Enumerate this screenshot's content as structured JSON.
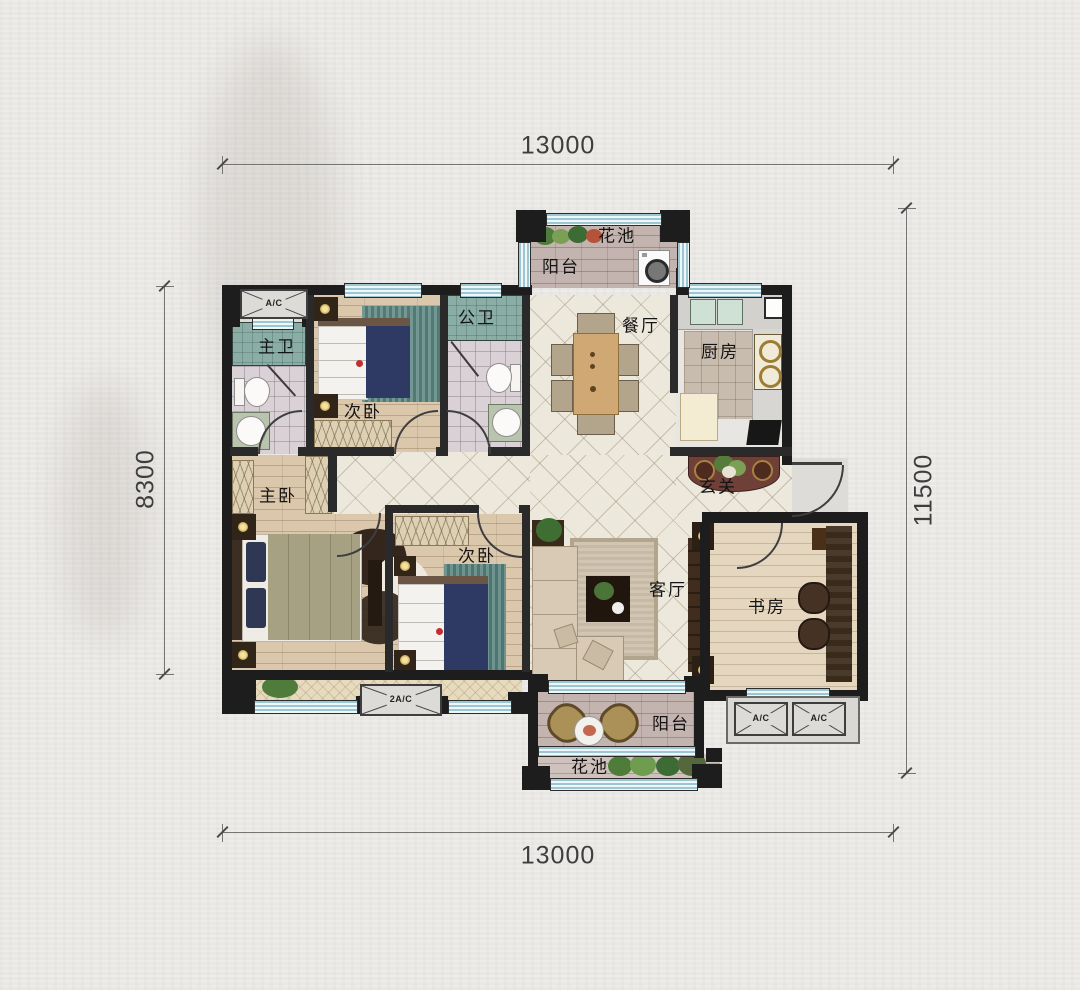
{
  "dims": {
    "top": "13000",
    "bottom": "13000",
    "left": "8300",
    "right": "11500"
  },
  "rooms": {
    "flower_bed_top": "花池",
    "balcony_top": "阳台",
    "dining": "餐厅",
    "kitchen": "厨房",
    "bath_public": "公卫",
    "bath_master": "主卫",
    "bedroom_second_top": "次卧",
    "bedroom_master": "主卧",
    "bedroom_second_bottom": "次卧",
    "entry": "玄关",
    "living": "客厅",
    "study": "书房",
    "balcony_bottom": "阳台",
    "flower_bed_bottom": "花池"
  },
  "ac": {
    "top_left": "A/C",
    "bottom_left": "2A/C",
    "bottom_right_1": "A/C",
    "bottom_right_2": "A/C"
  }
}
